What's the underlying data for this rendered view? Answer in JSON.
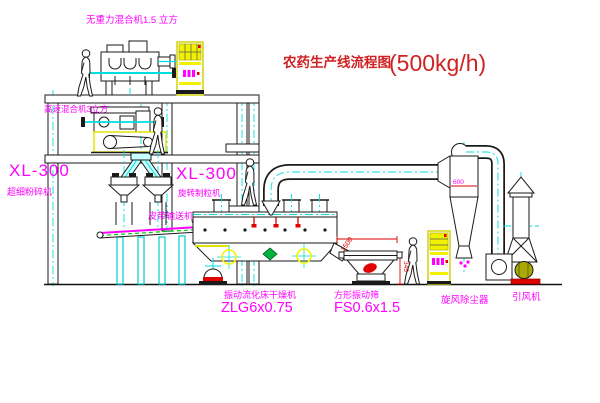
{
  "title": {
    "name": "农药生产线流程图",
    "capacity": "(500kg/h)"
  },
  "labels": {
    "gravity_mixer": "无重力混合机1.5 立方",
    "high_speed_mixer": "高速混合机3立方",
    "mill_model": "XL-300",
    "mill_name": "超细粉碎机",
    "granulator_model": "XL-300",
    "granulator_name": "旋转制粒机",
    "belt_conveyor": "皮带输送机",
    "dryer_name": "振动流化床干燥机",
    "dryer_model": "ZLG6x0.75",
    "sieve_name": "方形振动筛",
    "sieve_model": "FS0.6x1.5",
    "cyclone": "旋风除尘器",
    "fan": "引风机"
  },
  "dimensions": {
    "cyclone_dia": "600",
    "sieve_length": "1500",
    "sieve_height": "345"
  },
  "colors": {
    "label_magenta": "#ff00ff",
    "title_red": "#cf2222",
    "line_black": "#1a1a1a",
    "centerline_cyan": "#00dede",
    "equipment_yellow": "#f2f200",
    "conveyor_green": "#00cc00",
    "dimension_red": "#e00000",
    "motor_olive": "#a8a800"
  }
}
